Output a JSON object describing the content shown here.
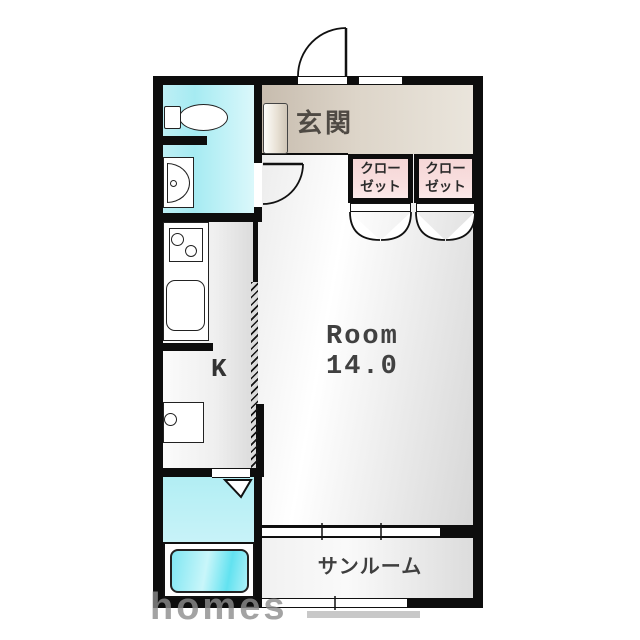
{
  "floorplan": {
    "rooms": {
      "genkan": {
        "label": "玄関"
      },
      "closet1": {
        "line1": "クロー",
        "line2": "ゼット"
      },
      "closet2": {
        "line1": "クロー",
        "line2": "ゼット"
      },
      "kitchen": {
        "label": "K"
      },
      "main_room": {
        "label": "Room",
        "size": "14.0"
      },
      "sunroom": {
        "label": "サンルーム"
      }
    },
    "watermark": {
      "text": "homes"
    },
    "fixtures": [
      "toilet",
      "washbasin",
      "stove",
      "kitchen-sink",
      "washing-machine-pan",
      "bathtub",
      "shoe-cabinet"
    ],
    "colors": {
      "wall": "#0d0d0d",
      "washroom_cyan": "#a6ebf2",
      "bath_cyan": "#c8f3f8",
      "bathtub_cyan": "#62e2f0",
      "genkan_beige": "#d6ccc0",
      "closet_pink": "#f7dbdb",
      "room_floor_grey": "#e3e3e3",
      "label_grey": "#3f3f3f",
      "watermark_grey": "#8d8d8d"
    }
  }
}
